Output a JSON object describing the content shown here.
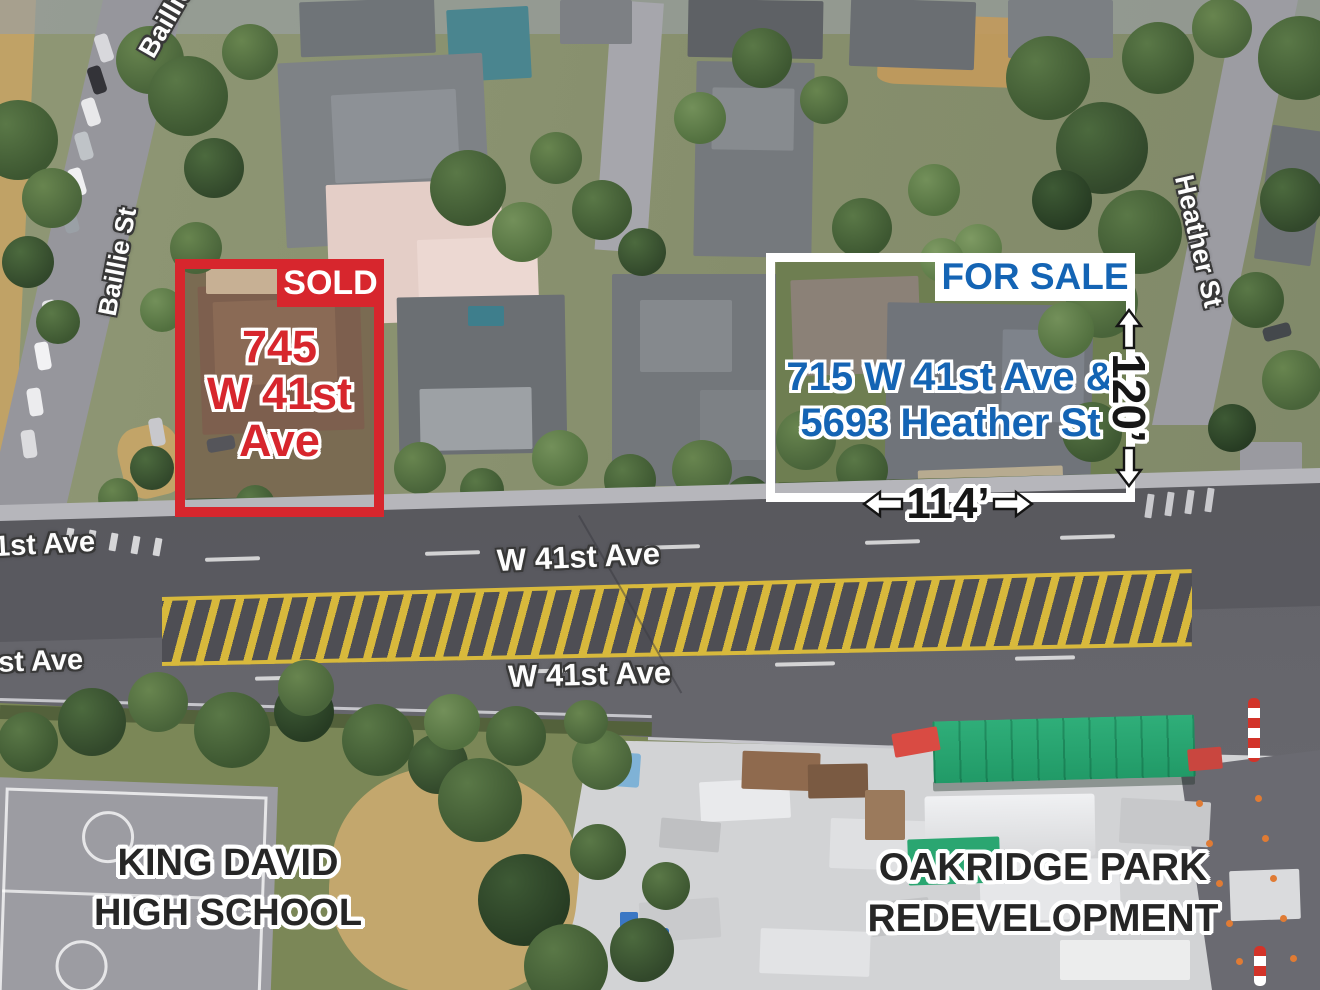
{
  "listing_sold": {
    "badge": "SOLD",
    "address_lines": [
      "745",
      "W 41st",
      "Ave"
    ]
  },
  "listing_for_sale": {
    "badge": "FOR SALE",
    "address_lines": [
      "715 W 41st Ave &",
      "5693 Heather St"
    ]
  },
  "dimensions": {
    "lot_depth": "120’",
    "lot_frontage": "114’"
  },
  "street_labels": {
    "baillie_top": "Baillie St",
    "baillie": "Baillie St",
    "heather": "Heather St",
    "w41st_center_upper": "W 41st Ave",
    "w41st_center_lower": "W 41st Ave",
    "w41st_left_upper": "41st Ave",
    "w41st_left_lower": "41st Ave"
  },
  "area_labels": {
    "school": [
      "KING DAVID",
      "HIGH SCHOOL"
    ],
    "redevelopment": [
      "OAKRIDGE PARK",
      "REDEVELOPMENT"
    ]
  },
  "colors": {
    "sold_red": "#d7262d",
    "for_sale_blue": "#1464b4",
    "label_white": "#ffffff",
    "dimension_black": "#161616",
    "median_yellow": "#d8b93c",
    "tarp_green": "#2aa473"
  }
}
